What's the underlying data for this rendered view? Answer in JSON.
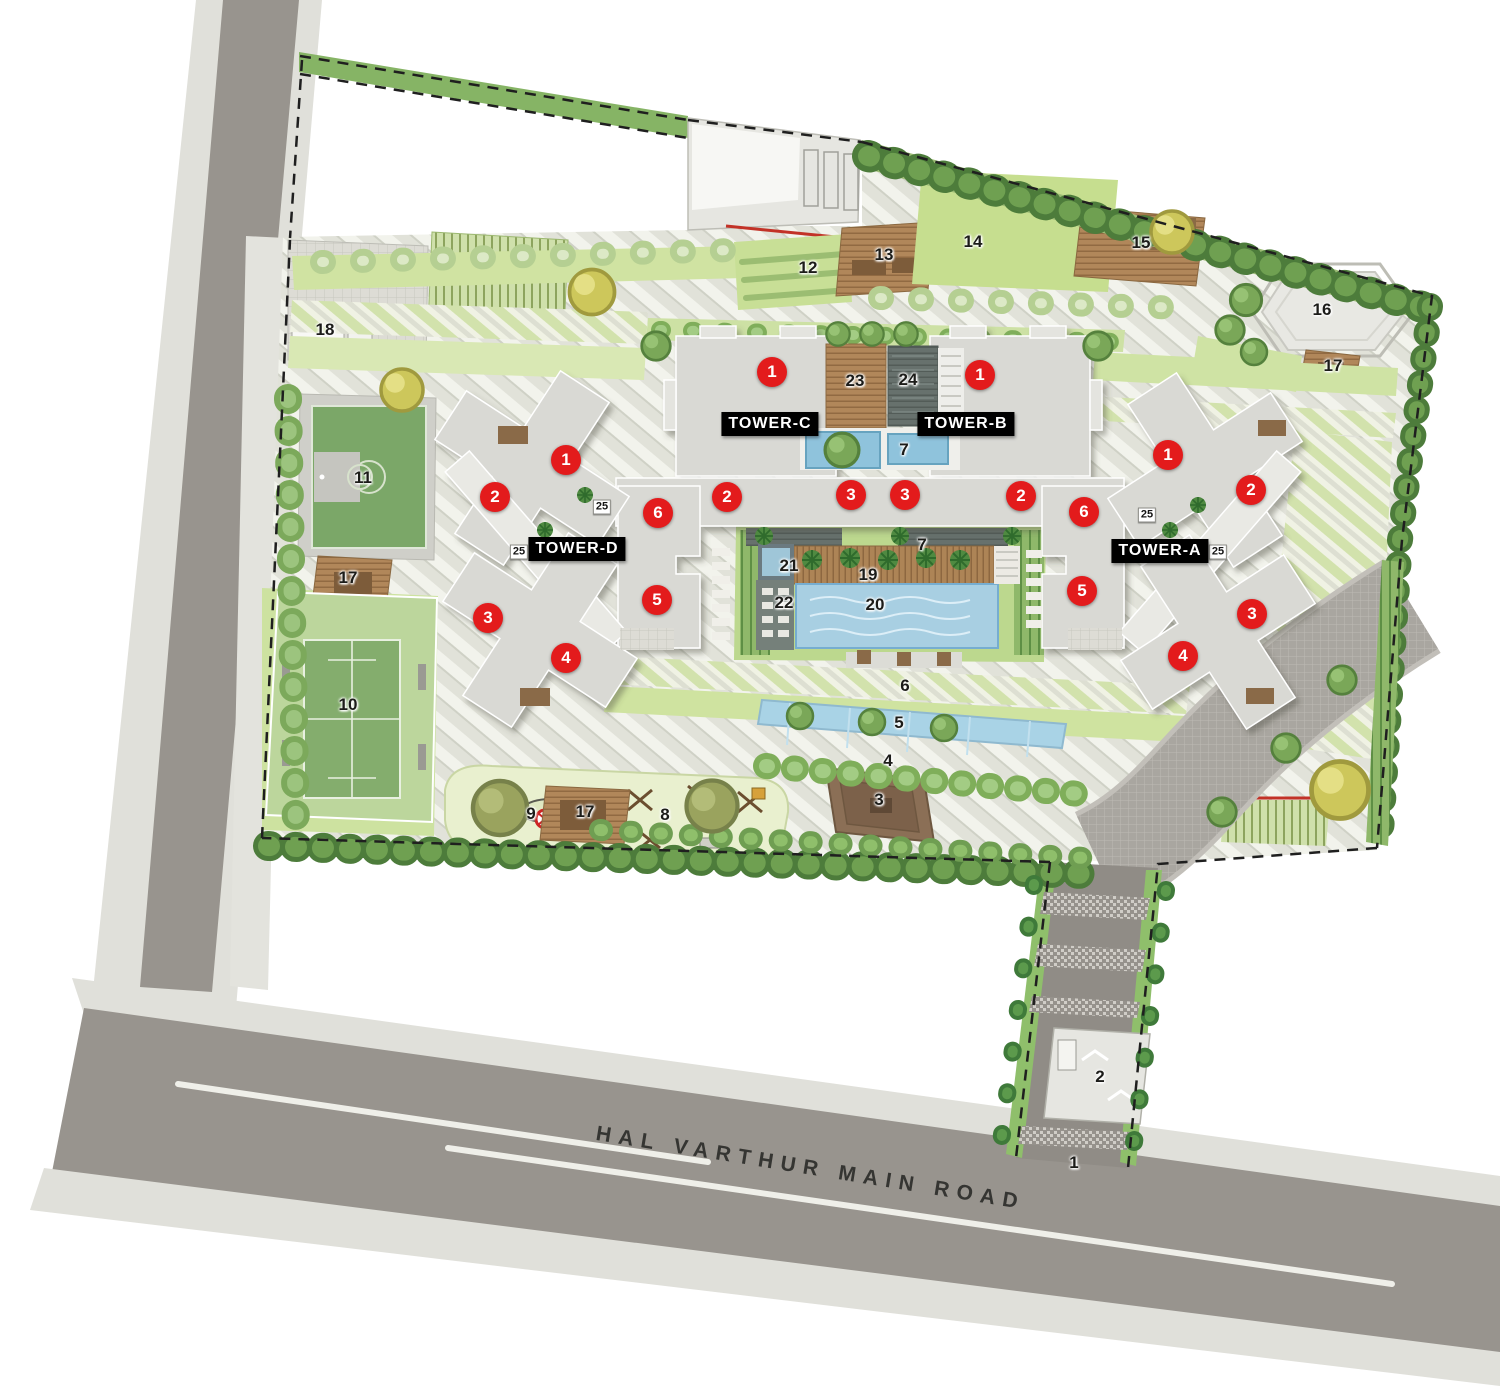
{
  "meta": {
    "description": "Residential master / site plan rendering with four towers and landscaped amenities"
  },
  "road": {
    "name": "HAL VARTHUR MAIN ROAD"
  },
  "tower_labels": [
    {
      "label": "TOWER-C",
      "x": 770,
      "y": 424
    },
    {
      "label": "TOWER-B",
      "x": 966,
      "y": 424
    },
    {
      "label": "TOWER-D",
      "x": 577,
      "y": 549
    },
    {
      "label": "TOWER-A",
      "x": 1160,
      "y": 551
    }
  ],
  "unit_markers": [
    {
      "label": "1",
      "x": 772,
      "y": 372
    },
    {
      "label": "1",
      "x": 980,
      "y": 375
    },
    {
      "label": "2",
      "x": 727,
      "y": 497
    },
    {
      "label": "3",
      "x": 851,
      "y": 495
    },
    {
      "label": "3",
      "x": 905,
      "y": 495
    },
    {
      "label": "2",
      "x": 1021,
      "y": 496
    },
    {
      "label": "6",
      "x": 658,
      "y": 513
    },
    {
      "label": "5",
      "x": 657,
      "y": 600
    },
    {
      "label": "6",
      "x": 1084,
      "y": 512
    },
    {
      "label": "5",
      "x": 1082,
      "y": 591
    },
    {
      "label": "1",
      "x": 566,
      "y": 460
    },
    {
      "label": "2",
      "x": 495,
      "y": 497
    },
    {
      "label": "3",
      "x": 488,
      "y": 618
    },
    {
      "label": "4",
      "x": 566,
      "y": 658
    },
    {
      "label": "1",
      "x": 1168,
      "y": 455
    },
    {
      "label": "2",
      "x": 1251,
      "y": 490
    },
    {
      "label": "3",
      "x": 1252,
      "y": 614
    },
    {
      "label": "4",
      "x": 1183,
      "y": 656
    }
  ],
  "amenity_markers": [
    {
      "label": "1",
      "x": 1074,
      "y": 1163
    },
    {
      "label": "2",
      "x": 1100,
      "y": 1077
    },
    {
      "label": "3",
      "x": 879,
      "y": 800
    },
    {
      "label": "4",
      "x": 888,
      "y": 761
    },
    {
      "label": "5",
      "x": 899,
      "y": 723
    },
    {
      "label": "6",
      "x": 905,
      "y": 686
    },
    {
      "label": "7",
      "x": 904,
      "y": 450
    },
    {
      "label": "7",
      "x": 922,
      "y": 545
    },
    {
      "label": "8",
      "x": 665,
      "y": 815
    },
    {
      "label": "9",
      "x": 531,
      "y": 814
    },
    {
      "label": "10",
      "x": 348,
      "y": 705
    },
    {
      "label": "11",
      "x": 363,
      "y": 478
    },
    {
      "label": "12",
      "x": 808,
      "y": 268
    },
    {
      "label": "13",
      "x": 884,
      "y": 255
    },
    {
      "label": "14",
      "x": 973,
      "y": 242
    },
    {
      "label": "15",
      "x": 1141,
      "y": 243
    },
    {
      "label": "16",
      "x": 1322,
      "y": 310
    },
    {
      "label": "17",
      "x": 348,
      "y": 578
    },
    {
      "label": "17",
      "x": 585,
      "y": 812
    },
    {
      "label": "17",
      "x": 1333,
      "y": 366
    },
    {
      "label": "18",
      "x": 325,
      "y": 330
    },
    {
      "label": "19",
      "x": 868,
      "y": 575
    },
    {
      "label": "20",
      "x": 875,
      "y": 605
    },
    {
      "label": "21",
      "x": 789,
      "y": 566
    },
    {
      "label": "22",
      "x": 784,
      "y": 603
    },
    {
      "label": "23",
      "x": 855,
      "y": 381
    },
    {
      "label": "24",
      "x": 908,
      "y": 380
    }
  ],
  "tag_markers": [
    {
      "label": "25",
      "x": 602,
      "y": 507
    },
    {
      "label": "25",
      "x": 519,
      "y": 552
    },
    {
      "label": "25",
      "x": 1147,
      "y": 515
    },
    {
      "label": "25",
      "x": 1218,
      "y": 552
    }
  ],
  "colors": {
    "marker_red": "#e31b1c",
    "tower_label_bg": "#000000",
    "tower_label_text": "#ffffff",
    "road_asphalt": "#98948e",
    "sidewalk": "#e0e0da",
    "lawn": "#cde2a0",
    "pool_water": "#a8cfe2",
    "deck_brown": "#b1875a",
    "building": "#d9d9d4",
    "hedge": "#4d7c3b"
  }
}
